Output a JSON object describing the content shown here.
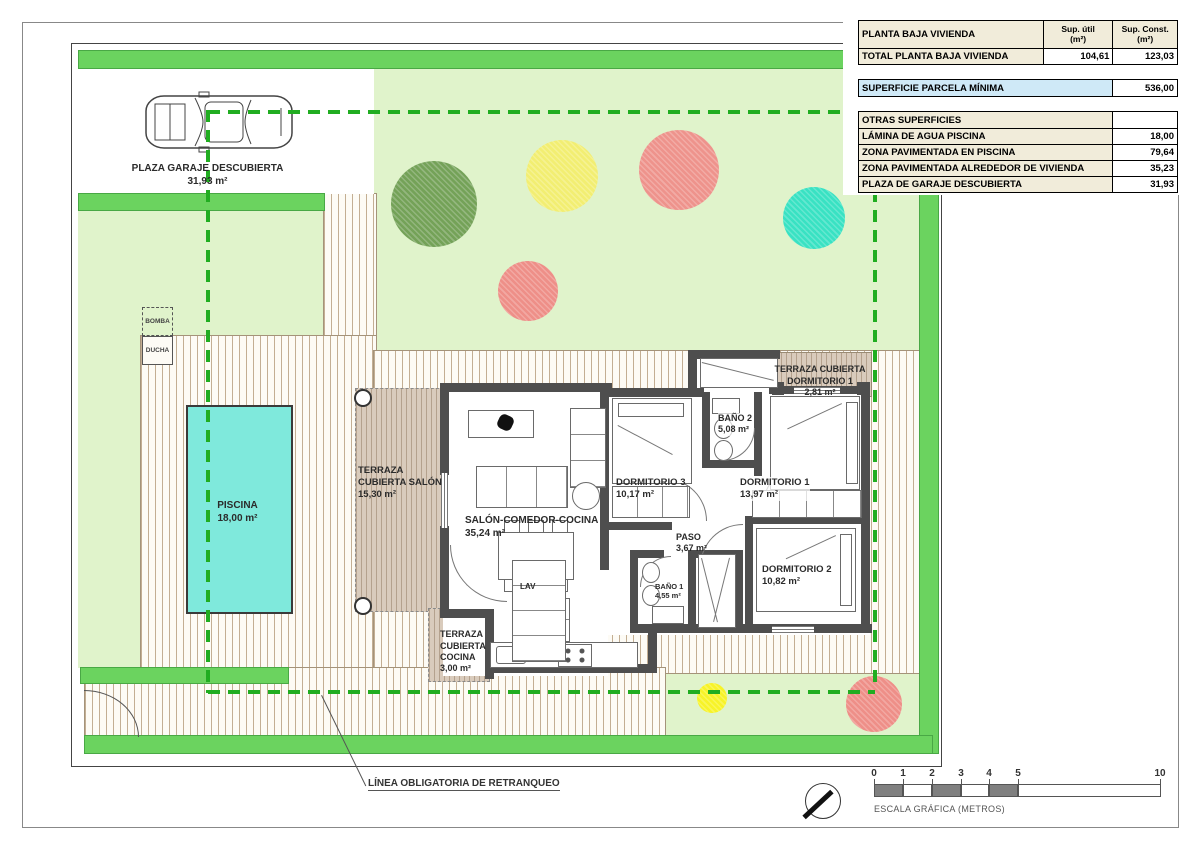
{
  "table": {
    "col_headers": {
      "main": "PLANTA BAJA VIVIENDA",
      "util": "Sup. útil\n(m²)",
      "const": "Sup. Const.\n(m²)"
    },
    "total": {
      "label": "TOTAL PLANTA BAJA VIVIENDA",
      "util": "104,61",
      "const": "123,03"
    },
    "parcela": {
      "label": "SUPERFICIE PARCELA MÍNIMA",
      "value": "536,00"
    },
    "otras_header": "OTRAS SUPERFICIES",
    "otras_rows": [
      {
        "label": "LÁMINA DE AGUA PISCINA",
        "value": "18,00"
      },
      {
        "label": "ZONA PAVIMENTADA EN PISCINA",
        "value": "79,64"
      },
      {
        "label": "ZONA PAVIMENTADA ALREDEDOR DE VIVIENDA",
        "value": "35,23"
      },
      {
        "label": "PLAZA DE GARAJE DESCUBIERTA",
        "value": "31,93"
      }
    ]
  },
  "site": {
    "garage": {
      "name": "PLAZA GARAJE DESCUBIERTA",
      "area": "31,93 m²"
    },
    "bomba": "BOMBA",
    "ducha": "DUCHA",
    "piscina": {
      "name": "PISCINA",
      "area": "18,00 m²"
    },
    "setback_line": "LÍNEA OBLIGATORIA DE RETRANQUEO"
  },
  "rooms": {
    "salon": {
      "name": "SALÓN-COMEDOR-COCINA",
      "area": "35,24 m²"
    },
    "dormitorio3": {
      "name": "DORMITORIO 3",
      "area": "10,17 m²"
    },
    "dormitorio1": {
      "name": "DORMITORIO 1",
      "area": "13,97 m²"
    },
    "dormitorio2": {
      "name": "DORMITORIO 2",
      "area": "10,82 m²"
    },
    "bano2": {
      "name": "BAÑO 2",
      "area": "5,08 m²"
    },
    "bano1": {
      "name": "BAÑO 1",
      "area": "4,55 m²"
    },
    "paso": {
      "name": "PASO",
      "area": "3,67 m²"
    },
    "terraza_salon": {
      "name": "TERRAZA\nCUBIERTA SALÓN",
      "area": "15,30 m²"
    },
    "terraza_cocina": {
      "name": "TERRAZA\nCUBIERTA\nCOCINA",
      "area": "3,00 m²"
    },
    "terraza_dorm1": {
      "name": "TERRAZA CUBIERTA\nDORMITORIO 1",
      "area": "2,81 m²"
    },
    "lav": "LAV"
  },
  "scale_bar": {
    "ticks": [
      "0",
      "1",
      "2",
      "3",
      "4",
      "5",
      "10"
    ],
    "caption": "ESCALA GRÁFICA (METROS)"
  },
  "trees": [
    {
      "x": 434,
      "y": 204,
      "r": 43,
      "color": "#74a258"
    },
    {
      "x": 562,
      "y": 176,
      "r": 36,
      "color": "#f2ee72"
    },
    {
      "x": 679,
      "y": 170,
      "r": 40,
      "color": "#ee938c"
    },
    {
      "x": 814,
      "y": 218,
      "r": 31,
      "color": "#39e2c3"
    },
    {
      "x": 528,
      "y": 291,
      "r": 30,
      "color": "#ee8f88"
    },
    {
      "x": 712,
      "y": 698,
      "r": 15,
      "color": "#f7f328"
    },
    {
      "x": 874,
      "y": 704,
      "r": 28,
      "color": "#ee8f88"
    }
  ],
  "colors": {
    "hedge": "#6bd35f",
    "lawn": "#e0f3cb",
    "pool": "#7fe9dc",
    "setback_green": "#21ad21",
    "table_beige": "#f1ecda",
    "table_blue": "#cfe9f7"
  }
}
